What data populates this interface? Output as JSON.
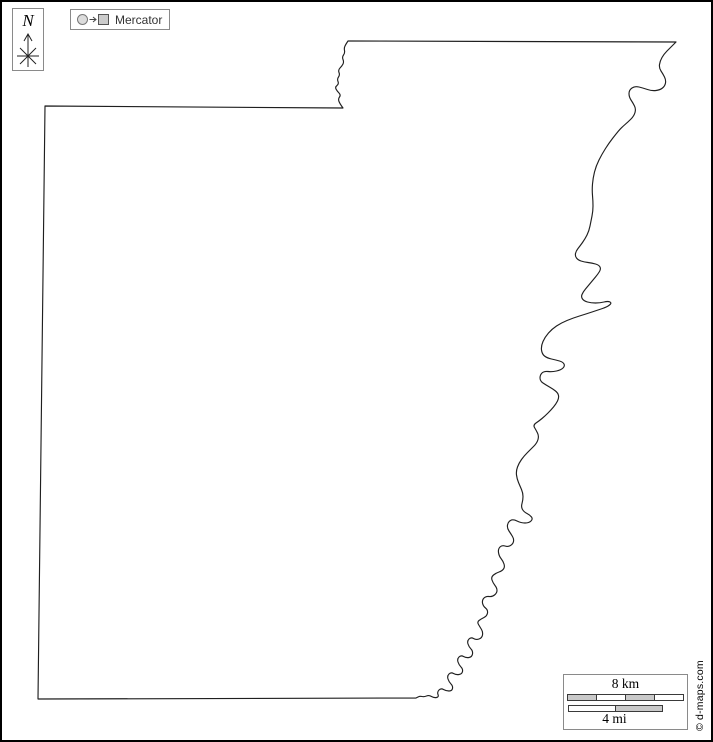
{
  "compass": {
    "label": "N"
  },
  "projection": {
    "label": "Mercator"
  },
  "scale": {
    "km_label": "8 km",
    "mi_label": "4 mi"
  },
  "copyright": "© d-maps.com",
  "icons": {
    "compass": "north-arrow-icon",
    "projection": "sphere-to-plane-icon"
  },
  "colors": {
    "outline": "#1f1f1f",
    "box-border": "#8a8a8a",
    "bar-gray": "#c9c9c9",
    "bar-border": "#3a3a3a",
    "text": "#000000"
  }
}
